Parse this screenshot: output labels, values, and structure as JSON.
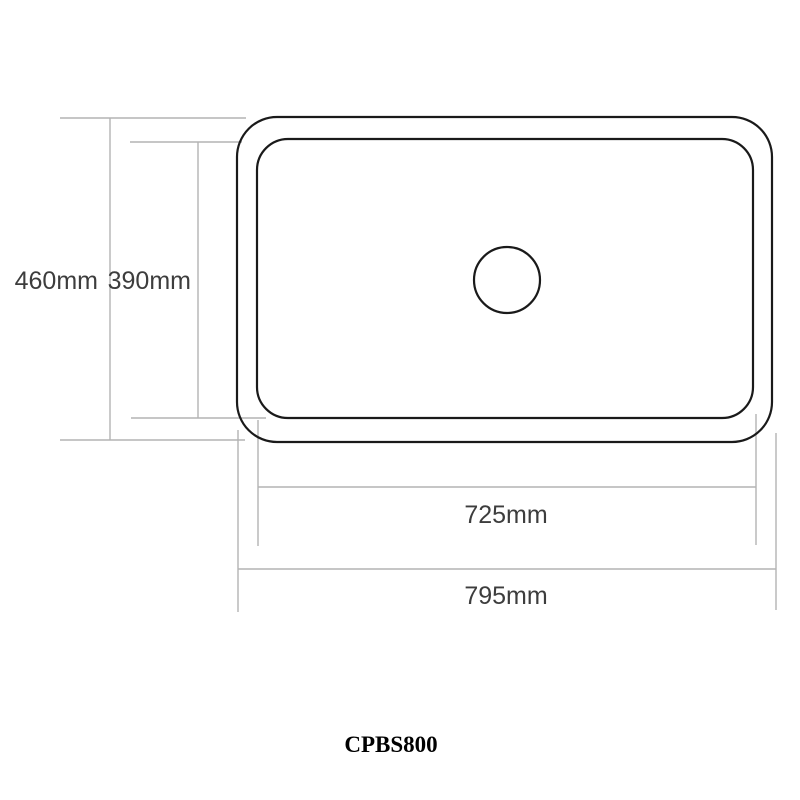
{
  "drawing": {
    "type": "sink-dimension-diagram",
    "product_code": "CPBS800",
    "dimensions": {
      "overall_height": {
        "label": "460mm",
        "meaning": "overall front-to-back depth"
      },
      "bowl_height": {
        "label": "390mm",
        "meaning": "inner bowl front-to-back depth"
      },
      "bowl_width": {
        "label": "725mm",
        "meaning": "inner bowl width"
      },
      "overall_width": {
        "label": "795mm",
        "meaning": "overall width"
      }
    },
    "shapes": {
      "outer_outline": "rounded rectangle (sink rim)",
      "inner_outline": "rounded rectangle (bowl)",
      "drain_hole": "circle at bowl center"
    }
  },
  "theme": {
    "background": "#ffffff",
    "outline_color": "#1a1a1a",
    "dimension_line_color": "#b3b3b3",
    "label_color": "#3d3d3d",
    "product_code_color": "#000000"
  }
}
